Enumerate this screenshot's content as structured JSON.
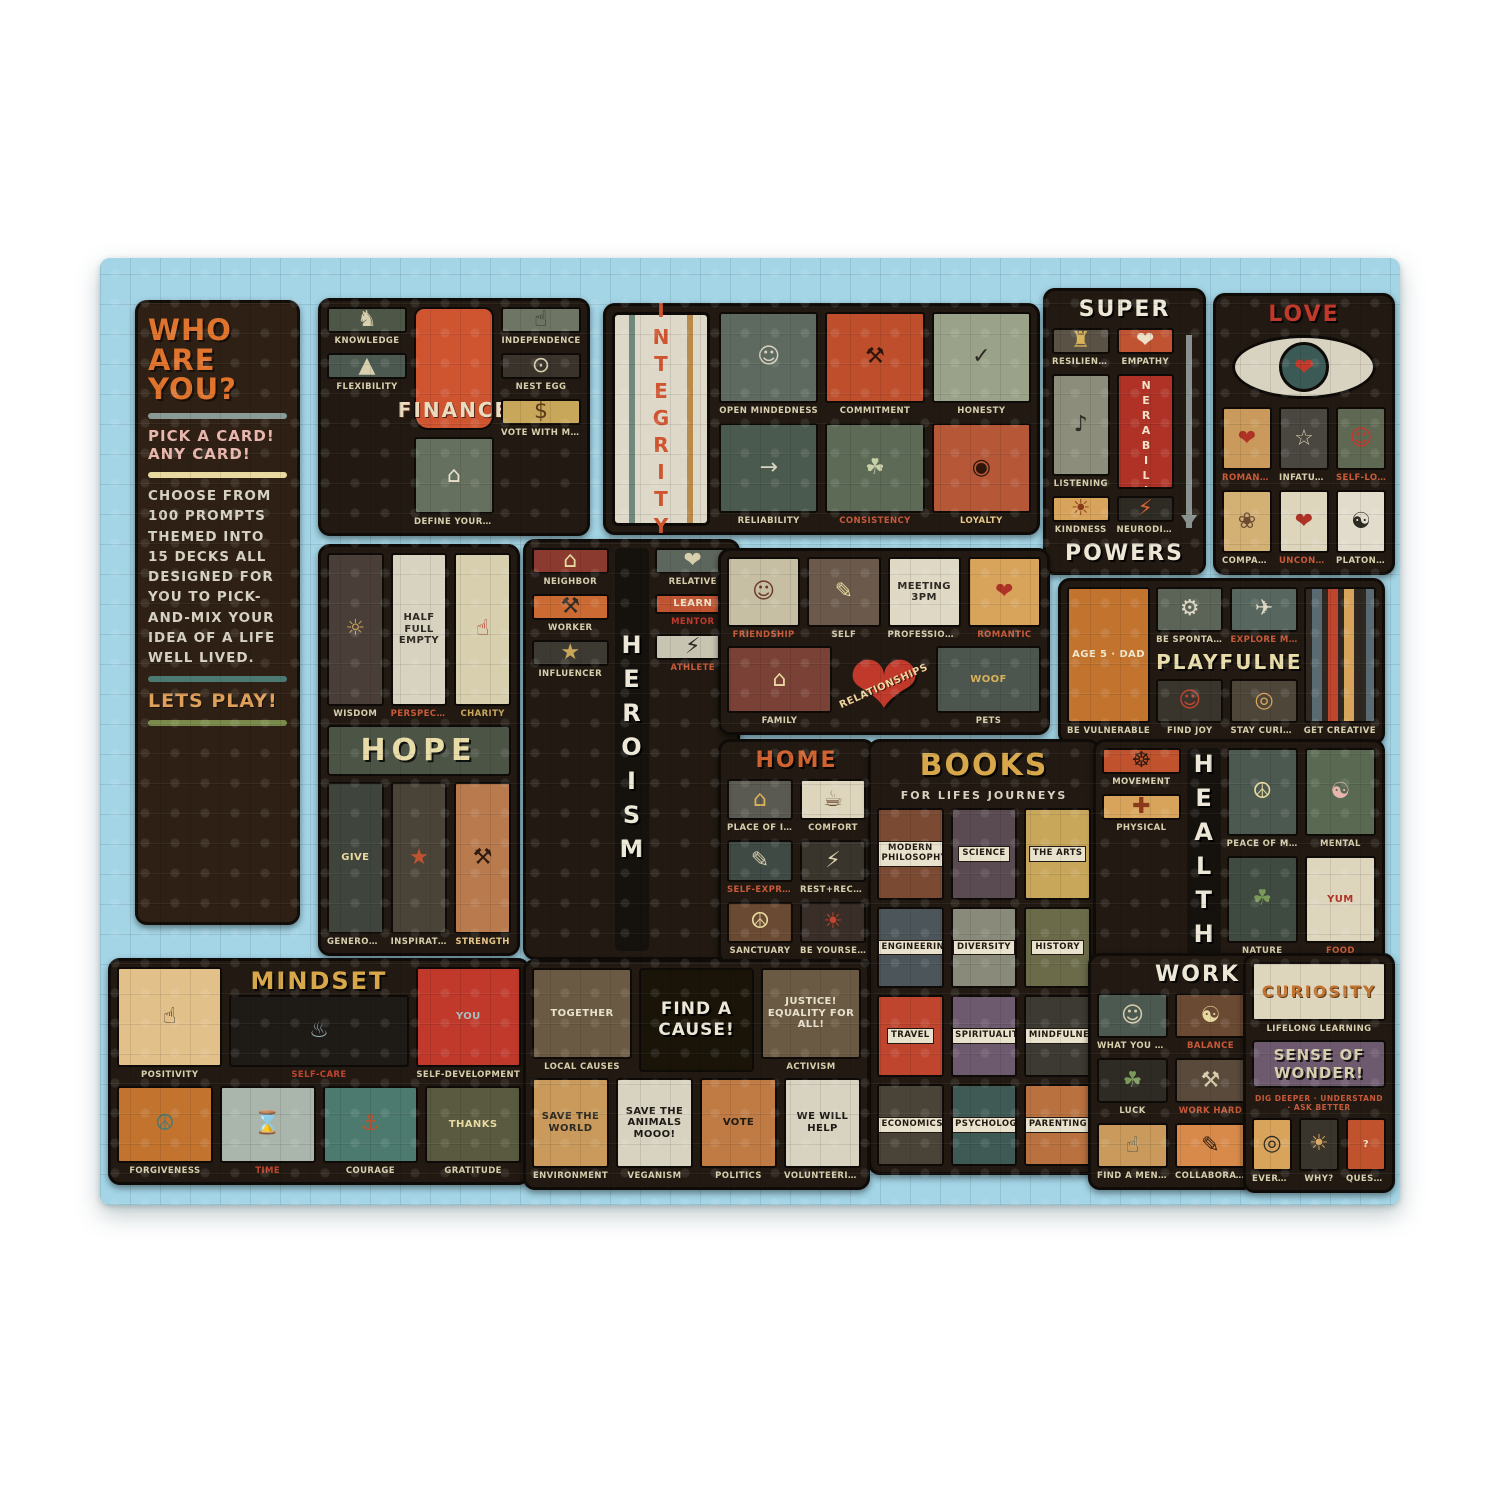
{
  "colors": {
    "page_bg": "#ffffff",
    "puzzle_bg": "#a3d5e6",
    "panel_bg": "#221a12",
    "accent_orange": "#d2622f",
    "accent_red": "#c0392b",
    "cream": "#ddd3b4",
    "gold": "#d8a74a",
    "pink": "#e9b6ae"
  },
  "intro": {
    "title": "WHO ARE YOU?",
    "subtitle": "PICK A CARD! ANY CARD!",
    "body": "CHOOSE FROM 100 PROMPTS THEMED INTO 15 DECKS ALL DESIGNED FOR YOU TO PICK-AND-MIX YOUR IDEA OF A LIFE WELL LIVED.",
    "footer": "LETS PLAY!",
    "dividers": [
      "#8a9a96",
      "#e8d9a0",
      "#4c7a72",
      "#7a8a4a"
    ]
  },
  "panels": {
    "finance": {
      "title": "FINANCE",
      "left": [
        {
          "label": "KNOWLEDGE",
          "icon": "♞",
          "icon_name": "creature-icon",
          "bg": "#4e5747",
          "fg": "#d8cfae"
        },
        {
          "label": "FLEXIBILITY",
          "icon": "▲",
          "icon_name": "mountain-climber-icon",
          "bg": "#4c5950",
          "fg": "#d8cfae"
        }
      ],
      "center": [
        {
          "label": "DEFINE YOUR SUCCESS",
          "icon": "⌂",
          "icon_name": "house-icon",
          "bg": "#66705e",
          "fg": "#e8e2cc"
        }
      ],
      "right": [
        {
          "label": "INDEPENDENCE",
          "icon": "☝",
          "icon_name": "thumbs-up-badge-icon",
          "bg": "#6e7565",
          "fg": "#2e2a24"
        },
        {
          "label": "NEST EGG",
          "icon": "⊙",
          "icon_name": "nest-egg-icon",
          "bg": "#3a332c",
          "fg": "#d8cfae"
        },
        {
          "label": "VOTE WITH MONEY",
          "icon": "$",
          "icon_name": "coin-icon",
          "bg": "#c9a75a",
          "fg": "#5a3a1a"
        }
      ]
    },
    "integrity": {
      "title": "INTEGRITY",
      "cards": [
        {
          "label": "OPEN MINDEDNESS",
          "icon": "☺",
          "icon_name": "open-head-icon",
          "bg": "#5e6a60",
          "fg": "#d8d2c0"
        },
        {
          "label": "COMMITMENT",
          "icon": "⚒",
          "icon_name": "fist-icon",
          "bg": "#bf4f2c",
          "fg": "#2e140a"
        },
        {
          "label": "HONESTY",
          "icon": "✓",
          "icon_name": "check-icon",
          "bg": "#9aa389",
          "fg": "#2e2a24"
        },
        {
          "label": "RELIABILITY",
          "icon": "→",
          "icon_name": "arrow-icon",
          "bg": "#4b5a4e",
          "fg": "#d8d2c0"
        },
        {
          "label": "CONSISTENCY",
          "icon": "☘",
          "icon_name": "tree-icon",
          "bg": "#5c6a56",
          "fg": "#c9cfa8",
          "lc": "#c85a3a"
        },
        {
          "label": "LOYALTY",
          "icon": "◉",
          "icon_name": "dog-badge-icon",
          "bg": "#b65737",
          "fg": "#2e140a",
          "lc": "#e8c88a"
        }
      ]
    },
    "superpowers": {
      "title_top": "SUPER",
      "title_bottom": "POWERS",
      "cards": [
        {
          "label": "RESILIENCE",
          "icon": "♜",
          "icon_name": "shield-icon",
          "bg": "#5a5245",
          "fg": "#d8b35a"
        },
        {
          "label": "EMPATHY",
          "icon": "❤",
          "icon_name": "heart-icon",
          "bg": "#c05332",
          "fg": "#f0e2c8"
        },
        {
          "label": "LISTENING",
          "icon": "♪",
          "icon_name": "ear-icon",
          "bg": "#8d8d7b",
          "fg": "#2e2a24"
        },
        {
          "label": "",
          "text": "VULNERABILITY",
          "vertical": true,
          "name": "vulnerability-card",
          "bg": "#b03226",
          "fg": "#f0e2c8"
        },
        {
          "label": "KINDNESS",
          "icon": "☀",
          "icon_name": "helping-hand-icon",
          "bg": "#d8a45c",
          "fg": "#8a3a1a"
        },
        {
          "label": "NEURODIVERSITY",
          "icon": "⚡",
          "icon_name": "lightning-icon",
          "bg": "#2e2a24",
          "fg": "#d2622f"
        }
      ]
    },
    "love": {
      "title": "LOVE",
      "cards": [
        {
          "label": "ROMANTIC",
          "icon": "❤",
          "icon_name": "heart-face-icon",
          "bg": "#c99a5b",
          "fg": "#b03226",
          "lc": "#c85a3a"
        },
        {
          "label": "INFATUATION",
          "icon": "☆",
          "icon_name": "ladder-heart-icon",
          "bg": "#4a4640",
          "fg": "#d8cfae"
        },
        {
          "label": "SELF-LOVE",
          "icon": "☺",
          "icon_name": "hand-on-heart-icon",
          "bg": "#5f6852",
          "fg": "#c0392b",
          "lc": "#c85a3a"
        },
        {
          "label": "COMPANIONSHIP",
          "icon": "❀",
          "icon_name": "two-towers-icon",
          "bg": "#d3b073",
          "fg": "#6b4a33"
        },
        {
          "label": "UNCONDITIONAL",
          "icon": "❤",
          "icon_name": "heart-bag-icon",
          "bg": "#ded5bd",
          "fg": "#b03226",
          "lc": "#c85a3a"
        },
        {
          "label": "PLATONIC",
          "icon": "☯",
          "icon_name": "abstract-pattern-icon",
          "bg": "#e2dccc",
          "fg": "#2e2a24"
        }
      ]
    },
    "hope": {
      "title": "HOPE",
      "top": [
        {
          "label": "WISDOM",
          "icon": "☼",
          "icon_name": "wheel-icon",
          "bg": "#4a3f38",
          "fg": "#c9a75a"
        },
        {
          "label": "PERSPECTIVE",
          "text": "HALF FULL EMPTY",
          "name": "perspective-card",
          "bg": "#d8d2c0",
          "fg": "#2e2a24",
          "lc": "#c85a3a"
        },
        {
          "label": "CHARITY",
          "icon": "☝",
          "icon_name": "raised-hands-icon",
          "bg": "#d8cfae",
          "fg": "#b03226",
          "lc": "#c9a75a"
        }
      ],
      "bottom": [
        {
          "label": "GENEROSITY",
          "text": "GIVE",
          "name": "generosity-card",
          "bg": "#3f453c",
          "fg": "#e8d9a0"
        },
        {
          "label": "INSPIRATION",
          "icon": "★",
          "icon_name": "star-icon",
          "bg": "#4a4438",
          "fg": "#c05332"
        },
        {
          "label": "STRENGTH",
          "icon": "⚒",
          "icon_name": "weightlifter-icon",
          "bg": "#b97a4e",
          "fg": "#2e1a0e",
          "lc": "#e8c88a"
        }
      ]
    },
    "heroism": {
      "title": "HEROISM",
      "left": [
        {
          "label": "NEIGHBOR",
          "icon": "⌂",
          "icon_name": "window-neighbor-icon",
          "bg": "#8a3a2e",
          "fg": "#e8d9a0"
        },
        {
          "label": "WORKER",
          "icon": "⚒",
          "icon_name": "worker-icon",
          "bg": "#cb6a33",
          "fg": "#2e2a24"
        },
        {
          "label": "INFLUENCER",
          "icon": "★",
          "icon_name": "influencer-icon",
          "bg": "#3c3a32",
          "fg": "#c9a75a"
        }
      ],
      "right": [
        {
          "label": "RELATIVE",
          "icon": "❤",
          "icon_name": "hug-icon",
          "bg": "#5d665c",
          "fg": "#d8cfae"
        },
        {
          "label": "MENTOR",
          "text": "LEARN",
          "name": "mentor-card",
          "bg": "#c05332",
          "fg": "#f0e2c8",
          "lc": "#c0392b"
        },
        {
          "label": "ATHLETE",
          "icon": "⚡",
          "icon_name": "runner-icon",
          "bg": "#c8c4b2",
          "fg": "#2e2a24",
          "lc": "#c85a3a"
        }
      ]
    },
    "relationships": {
      "title": "RELATIONSHIPS",
      "top": [
        {
          "label": "FRIENDSHIP",
          "icon": "☺",
          "icon_name": "two-friends-icon",
          "bg": "#c7bfa4",
          "fg": "#6b3a2a",
          "lc": "#c85a3a"
        },
        {
          "label": "SELF",
          "icon": "✎",
          "icon_name": "me-book-icon",
          "bg": "#6b5a4c",
          "fg": "#e8d9a0"
        },
        {
          "label": "PROFESSIONAL",
          "text": "MEETING 3PM",
          "name": "professional-card",
          "bg": "#ded8c4",
          "fg": "#2e2a24"
        },
        {
          "label": "ROMANTIC",
          "icon": "❤",
          "icon_name": "heart-couple-icon",
          "bg": "#d8a45c",
          "fg": "#b03226",
          "lc": "#c85a3a"
        }
      ],
      "bottom_left": [
        {
          "label": "FAMILY",
          "icon": "⌂",
          "icon_name": "family-portrait-icon",
          "bg": "#7a4136",
          "fg": "#e8d9a0"
        }
      ],
      "bottom_right": [
        {
          "label": "PETS",
          "text": "WOOF",
          "name": "pets-card",
          "bg": "#4c554e",
          "fg": "#d8b35a"
        }
      ]
    },
    "playfulness": {
      "title": "PLAYFULNESS",
      "left": [
        {
          "label": "BE VULNERABLE",
          "text": "AGE 5 · DAD",
          "name": "kid-drawing-card",
          "bg": "#c2742f",
          "fg": "#f0e6cc"
        }
      ],
      "mid_top": [
        {
          "label": "BE SPONTANEOUS",
          "icon": "⚙",
          "icon_name": "roller-skate-icon",
          "bg": "#5b6456",
          "fg": "#ded8c4"
        },
        {
          "label": "EXPLORE MORE",
          "icon": "✈",
          "icon_name": "rocket-icon",
          "bg": "#57675f",
          "fg": "#ded8c4",
          "lc": "#c85a3a"
        }
      ],
      "mid_bottom": [
        {
          "label": "FIND JOY",
          "icon": "☺",
          "icon_name": "robot-icon",
          "bg": "#3a352c",
          "fg": "#c0452e"
        },
        {
          "label": "STAY CURIOUS",
          "icon": "◎",
          "icon_name": "binoculars-icon",
          "bg": "#4e4639",
          "fg": "#d8a45c"
        }
      ],
      "right": [
        {
          "label": "GET CREATIVE",
          "name": "crayons-card",
          "cls": "crayons",
          "bg": "",
          "icon": "",
          "icon_name": "crayons-icon"
        }
      ]
    },
    "home": {
      "title": "HOME",
      "cards": [
        {
          "label": "PLACE OF INTIMACY",
          "icon": "⌂",
          "icon_name": "city-building-icon",
          "bg": "#5a5a52",
          "fg": "#d8b35a"
        },
        {
          "label": "COMFORT",
          "icon": "☕",
          "icon_name": "mug-icon",
          "bg": "#ded5bd",
          "fg": "#6b4a33"
        },
        {
          "label": "SELF-EXPRESSION",
          "icon": "✎",
          "icon_name": "hand-pencil-icon",
          "bg": "#3f4a44",
          "fg": "#d8cfae",
          "lc": "#c85a3a"
        },
        {
          "label": "REST+RECHARGE",
          "icon": "⚡",
          "icon_name": "battery-icon",
          "bg": "#3a352c",
          "fg": "#d8cfae"
        },
        {
          "label": "SANCTUARY",
          "icon": "☮",
          "icon_name": "sanctuary-icon",
          "bg": "#6b4a33",
          "fg": "#e8d9a0"
        },
        {
          "label": "BE YOURSELF",
          "icon": "☀",
          "icon_name": "hearth-icon",
          "bg": "#3a2e28",
          "fg": "#c0452e"
        }
      ]
    },
    "books": {
      "title": "BOOKS",
      "subtitle": "FOR LIFES JOURNEYS",
      "cards": [
        {
          "text": "MODERN PHILOSOPHY",
          "name": "book-spine",
          "cls": "book",
          "bg": "#7a4a33"
        },
        {
          "text": "SCIENCE",
          "name": "book-spine",
          "cls": "book",
          "bg": "#5a4a52"
        },
        {
          "text": "THE ARTS",
          "name": "book-spine",
          "cls": "book",
          "bg": "#c9a75a"
        },
        {
          "text": "ENGINEERING",
          "name": "book-spine",
          "cls": "book",
          "bg": "#4c555a"
        },
        {
          "text": "DIVERSITY",
          "name": "book-spine",
          "cls": "book",
          "bg": "#8a8a7a"
        },
        {
          "text": "HISTORY",
          "name": "book-spine",
          "cls": "book",
          "bg": "#6b6b4a"
        },
        {
          "text": "TRAVEL",
          "name": "book-spine",
          "cls": "book",
          "bg": "#c0452e"
        },
        {
          "text": "SPIRITUALITY",
          "name": "book-spine",
          "cls": "book",
          "bg": "#6e5a6e"
        },
        {
          "text": "MINDFULNESS",
          "name": "book-spine",
          "cls": "book",
          "bg": "#3c3a32"
        },
        {
          "text": "ECONOMICS",
          "name": "book-spine",
          "cls": "book",
          "bg": "#4a4438"
        },
        {
          "text": "PSYCHOLOGY",
          "name": "book-spine",
          "cls": "book",
          "bg": "#3f5a55"
        },
        {
          "text": "PARENTING",
          "name": "book-spine",
          "cls": "book",
          "bg": "#b9713f"
        }
      ]
    },
    "health": {
      "title": "HEALTH",
      "left": [
        {
          "label": "MOVEMENT",
          "icon": "☸",
          "icon_name": "bicycle-icon",
          "bg": "#c0532e",
          "fg": "#2e1a0e"
        },
        {
          "label": "PHYSICAL",
          "icon": "✚",
          "icon_name": "anatomy-icon",
          "bg": "#d8a45c",
          "fg": "#8a3a1a"
        }
      ],
      "right": [
        {
          "label": "PEACE OF MIND",
          "icon": "☮",
          "icon_name": "candle-window-icon",
          "bg": "#4c5950",
          "fg": "#e8d9a0"
        },
        {
          "label": "MENTAL",
          "icon": "☯",
          "icon_name": "head-flower-icon",
          "bg": "#5a6a52",
          "fg": "#e9b6ae"
        },
        {
          "label": "NATURE",
          "icon": "☘",
          "icon_name": "pine-trees-icon",
          "bg": "#3f4a40",
          "fg": "#7a9a5a"
        },
        {
          "label": "FOOD",
          "text": "YUM",
          "name": "apple-card",
          "bg": "#ded5bd",
          "fg": "#b03226",
          "lc": "#c85a3a"
        }
      ]
    },
    "mindset": {
      "title": "MINDSET",
      "top_left": [
        {
          "label": "POSITIVITY",
          "icon": "☝",
          "icon_name": "thumbs-up-icon",
          "bg": "#e2c089",
          "fg": "#2e2a24"
        }
      ],
      "top_center": [
        {
          "label": "SELF-CARE",
          "icon": "♨",
          "icon_name": "bathtub-icon",
          "bg": "#1e1a16",
          "fg": "#9ab0b5",
          "lc": "#c0452e"
        }
      ],
      "top_right": [
        {
          "label": "SELF-DEVELOPMENT",
          "text": "YOU",
          "name": "you-book-card",
          "bg": "#c0392b",
          "fg": "#a8c0c0"
        }
      ],
      "bottom": [
        {
          "label": "FORGIVENESS",
          "icon": "☮",
          "icon_name": "dove-icon",
          "bg": "#c2742f",
          "fg": "#4c7a72"
        },
        {
          "label": "TIME",
          "icon": "⌛",
          "icon_name": "clock-icon",
          "bg": "#aab5ac",
          "fg": "#3a332a",
          "lc": "#c0452e"
        },
        {
          "label": "COURAGE",
          "icon": "⚓",
          "icon_name": "anchor-icon",
          "bg": "#4c7a6e",
          "fg": "#c0532e"
        },
        {
          "label": "GRATITUDE",
          "text": "THANKS",
          "name": "thanks-card",
          "bg": "#5a5a40",
          "fg": "#e8d9a0"
        }
      ]
    },
    "cause": {
      "title": "FIND A CAUSE!",
      "top_left": [
        {
          "label": "LOCAL CAUSES",
          "text": "TOGETHER",
          "name": "together-banner-card",
          "bg": "#6b5a43",
          "fg": "#e8e2cc"
        }
      ],
      "top_right": [
        {
          "label": "ACTIVISM",
          "text": "JUSTICE! EQUALITY FOR ALL!",
          "name": "justice-card",
          "bg": "#6b5a43",
          "fg": "#e8e2cc"
        }
      ],
      "bottom": [
        {
          "label": "ENVIRONMENT",
          "text": "SAVE THE WORLD",
          "name": "environment-card",
          "bg": "#c99a5b",
          "fg": "#2e2a24"
        },
        {
          "label": "VEGANISM",
          "text": "SAVE THE ANIMALS MOOO!",
          "name": "veganism-card",
          "bg": "#d8d2c0",
          "fg": "#1e1a16"
        },
        {
          "label": "POLITICS",
          "text": "VOTE",
          "name": "vote-card",
          "bg": "#c07a43",
          "fg": "#1e1a16"
        },
        {
          "label": "VOLUNTEERING",
          "text": "WE WILL HELP",
          "name": "volunteering-card",
          "bg": "#d8d2c0",
          "fg": "#1e1a16"
        }
      ]
    },
    "work": {
      "title": "WORK",
      "cards": [
        {
          "label": "WHAT YOU DO",
          "icon": "☺",
          "icon_name": "person-icon",
          "bg": "#4c5950",
          "fg": "#d8cfae"
        },
        {
          "label": "BALANCE",
          "icon": "☯",
          "icon_name": "balance-icon",
          "bg": "#6b4a33",
          "fg": "#e8d9a0",
          "lc": "#c85a3a"
        },
        {
          "label": "LUCK",
          "icon": "☘",
          "icon_name": "clover-icon",
          "bg": "#2e2a24",
          "fg": "#7a9a5a"
        },
        {
          "label": "WORK HARD",
          "icon": "⚒",
          "icon_name": "hammer-icon",
          "bg": "#5a4a3c",
          "fg": "#d8cfae",
          "lc": "#c85a3a"
        },
        {
          "label": "FIND A MENTOR",
          "icon": "☝",
          "icon_name": "mentor-figures-icon",
          "bg": "#c99a5b",
          "fg": "#3f4a40"
        },
        {
          "label": "COLLABORATE",
          "icon": "✎",
          "icon_name": "pencil-hands-icon",
          "bg": "#d88a4a",
          "fg": "#2e1a0e"
        }
      ]
    },
    "curiosity": {
      "title": "CURIOSITY",
      "book_label": "LIFELONG LEARNING",
      "banner": "SENSE OF WONDER!",
      "tagline": "DIG DEEPER · UNDERSTAND · ASK BETTER",
      "bottom": [
        {
          "label": "EVERYTHING",
          "icon": "◎",
          "icon_name": "magnifying-glass-icon",
          "bg": "#d8a45c",
          "fg": "#2e2a24"
        },
        {
          "label": "WHY?",
          "icon": "☀",
          "icon_name": "lightbulb-head-icon",
          "bg": "#3a352c",
          "fg": "#d8a45c"
        },
        {
          "label": "QUESTIONS",
          "text": "?",
          "name": "question-card",
          "bg": "#c0532e",
          "fg": "#f0e2c8"
        }
      ]
    }
  }
}
